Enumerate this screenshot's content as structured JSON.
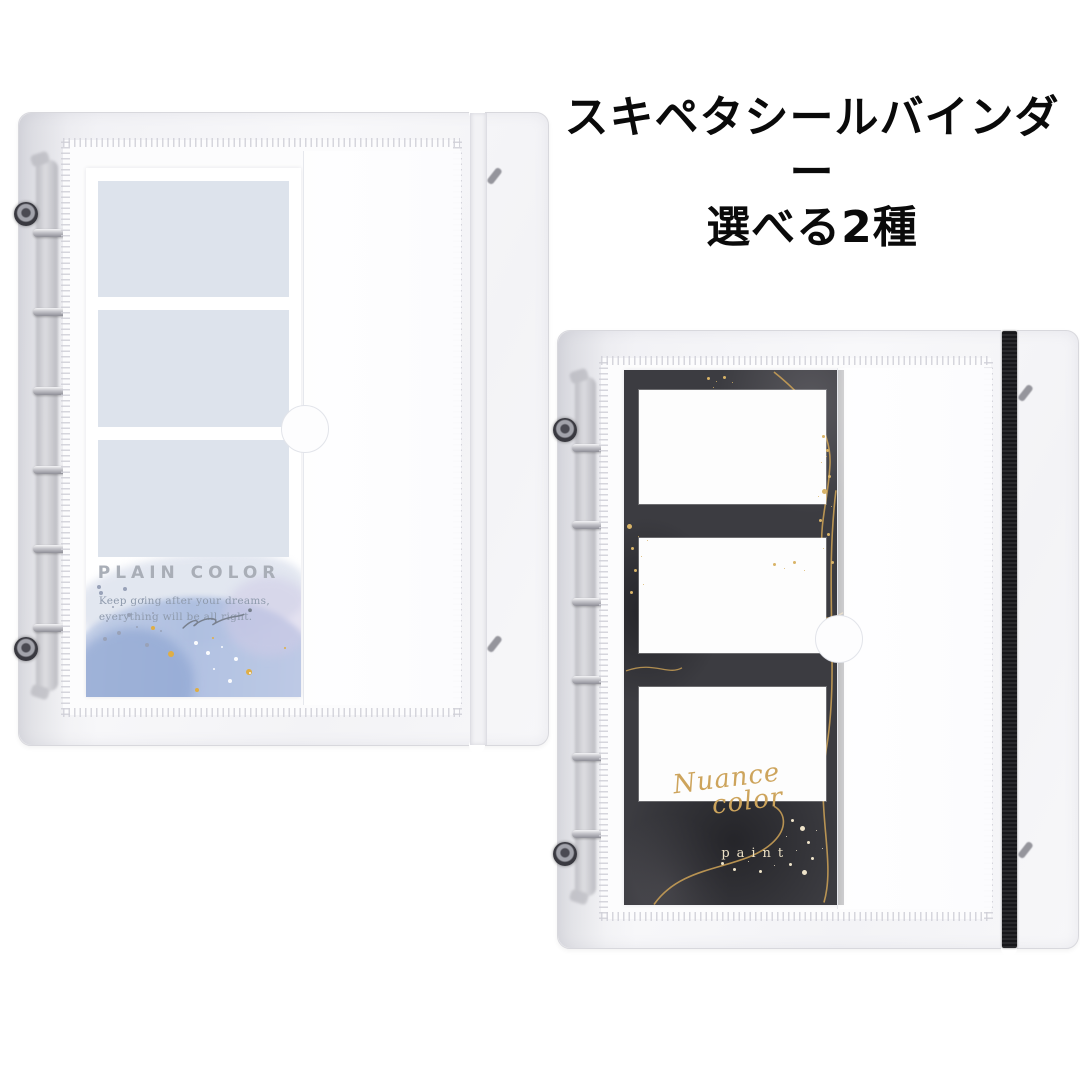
{
  "page": {
    "background": "#ffffff"
  },
  "header": {
    "title_line1": "スキペタシールバインダー",
    "title_line2": "選べる2種",
    "color": "#0a0a0a"
  },
  "binder_plain": {
    "label": "plain color binder",
    "band_color": "#f2f2f5",
    "ring_count": "6",
    "insert": {
      "title": "PLAIN COLOR",
      "subtitle_line1": "Keep going after your dreams,",
      "subtitle_line2": "everything will be all right.",
      "sheet_color": "#ffffff",
      "slot_color": "#dde3ec",
      "title_color": "#a9aeb7",
      "subtitle_color": "#8e9aac",
      "watercolor_blue": "#a9bbdf",
      "gold_dot_color": "#dfae45"
    }
  },
  "binder_nuance": {
    "label": "nuance color binder",
    "band_color": "#17171a",
    "ring_count": "6",
    "insert": {
      "script_text": "Nuance color",
      "sub_text": "paint",
      "background_color": "#3c3c41",
      "slot_color": "#fdfdfd",
      "gold_color": "#cda45c",
      "cream_color": "#ece1c6"
    }
  }
}
